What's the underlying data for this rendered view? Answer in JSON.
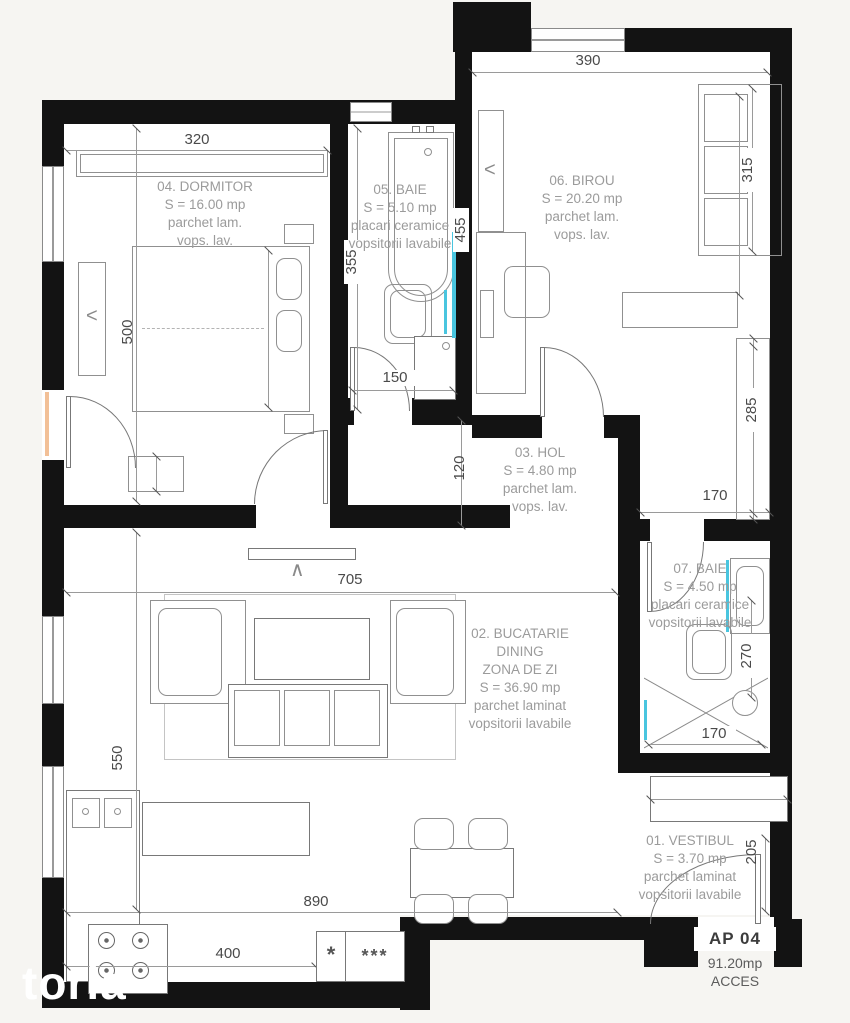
{
  "watermark": "toria",
  "unit": {
    "id": "AP 04",
    "area": "91.20mp",
    "access": "ACCES"
  },
  "rooms": {
    "vestibul": [
      "01. VESTIBUL",
      "S = 3.70 mp",
      "parchet laminat",
      "vopsitorii lavabile"
    ],
    "bucatarie": [
      "02. BUCATARIE",
      "DINING",
      "ZONA DE ZI",
      "S = 36.90 mp",
      "parchet laminat",
      "vopsitorii lavabile"
    ],
    "hol": [
      "03. HOL",
      "S = 4.80 mp",
      "parchet lam.",
      "vops. lav."
    ],
    "dormitor": [
      "04. DORMITOR",
      "S = 16.00 mp",
      "parchet lam.",
      "vops. lav."
    ],
    "baie5": [
      "05. BAIE",
      "S = 5.10 mp",
      "placari ceramice",
      "vopsitorii lavabile"
    ],
    "birou": [
      "06. BIROU",
      "S = 20.20 mp",
      "parchet lam.",
      "vops. lav."
    ],
    "baie7": [
      "07. BAIE",
      "S = 4.50 mp",
      "placari ceramice",
      "vopsitorii lavabile"
    ]
  },
  "dims": {
    "dorm_top": "320",
    "birou_top": "390",
    "dorm_left": "500",
    "living_left": "550",
    "baie5_left": "355",
    "baie5_right": "455",
    "baie5_door": "150",
    "hol_top": "120",
    "sofa_right": "315",
    "column_right": "285",
    "corridor_right": "170",
    "baie7_mid": "270",
    "shower_bottom": "170",
    "vestibul_right": "205",
    "living_top": "705",
    "bottom_total": "890",
    "kitchen_bottom": "400"
  },
  "symbols": {
    "one_star": "*",
    "three_star": "***",
    "radiator_mark": "<",
    "tv_mark": "∧"
  },
  "colors": {
    "wall": "#131313",
    "accent_cyan": "#49c5df",
    "accent_peach": "#f2c097",
    "room_label": "#9b9b9b",
    "dim_text": "#4a4a4a"
  }
}
